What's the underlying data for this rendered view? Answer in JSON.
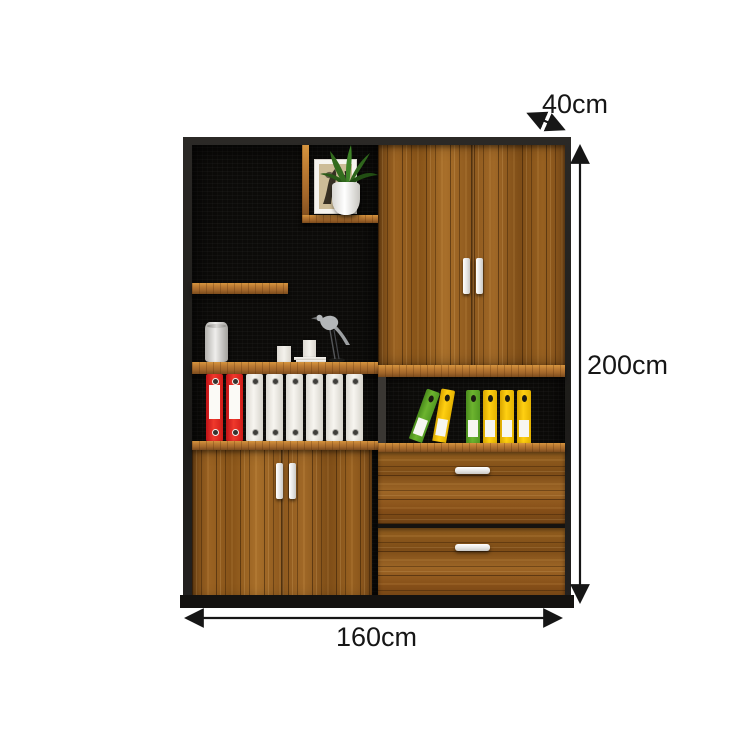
{
  "annotations": {
    "depth_label": "40cm",
    "height_label": "200cm",
    "width_label": "160cm"
  },
  "colors": {
    "background": "#ffffff",
    "frame_black": "#232120",
    "interior_black": "#0c0b09",
    "wood_mid": "#8a561e",
    "wood_light": "#b5762f",
    "wood_dark": "#6f4214",
    "handle_white": "#f2f1ef",
    "binder_red": "#e02520",
    "binder_white": "#f3f1ec",
    "binder_green": "#5ea626",
    "binder_yellow": "#f5c40a",
    "plant_green": "#35701f",
    "dimension_ink": "#161616"
  },
  "decor": {
    "top_cubby_items": [
      "framed-picture",
      "potted-plant",
      "white-vase"
    ],
    "middle_shelf_items": [
      "ceramic-jar",
      "white-box",
      "document-stack",
      "bird-sculpture"
    ]
  },
  "shelves": {
    "left_binders": [
      "red",
      "red",
      "white",
      "white",
      "white",
      "white",
      "white",
      "white"
    ],
    "right_binders": [
      {
        "color": "green",
        "lean": 20
      },
      {
        "color": "yellow",
        "lean": 10
      },
      {
        "color": "green",
        "lean": 0
      },
      {
        "color": "yellow",
        "lean": 0
      },
      {
        "color": "yellow",
        "lean": 0
      },
      {
        "color": "yellow",
        "lean": 0
      }
    ]
  }
}
